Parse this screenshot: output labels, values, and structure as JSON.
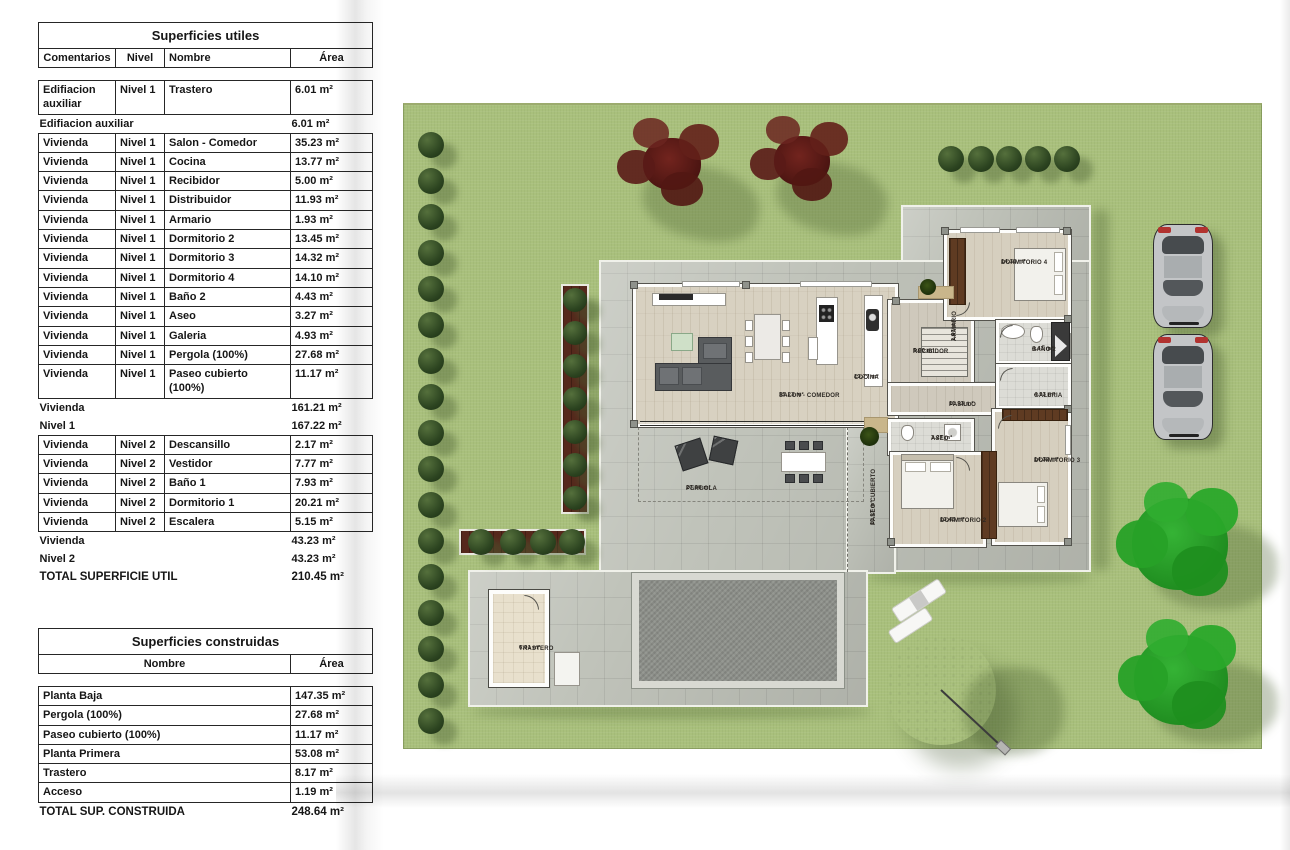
{
  "colors": {
    "lawn": "#a9c07c",
    "terrace": "#c0c3ba",
    "pool_water": "#8e918b",
    "wood_floor": "#d8d1c1",
    "wardrobe_wood": "#5f3b22",
    "bush_green": "#2c4420",
    "tree_red": "#5d1d1a",
    "tree_green": "#2aa02a",
    "table_text": "#161616"
  },
  "tables": {
    "utiles": {
      "title": "Superficies utiles",
      "columns": [
        "Comentarios",
        "Nivel",
        "Nombre",
        "Área"
      ],
      "rows": [
        {
          "type": "data",
          "comentarios": "Edifiacion auxiliar",
          "nivel": "Nivel 1",
          "nombre": "Trastero",
          "area": "6.01 m²"
        },
        {
          "type": "summary",
          "label": "Edifiacion auxiliar",
          "area": "6.01 m²"
        },
        {
          "type": "data",
          "comentarios": "Vivienda",
          "nivel": "Nivel 1",
          "nombre": "Salon - Comedor",
          "area": "35.23 m²"
        },
        {
          "type": "data",
          "comentarios": "Vivienda",
          "nivel": "Nivel 1",
          "nombre": "Cocina",
          "area": "13.77 m²"
        },
        {
          "type": "data",
          "comentarios": "Vivienda",
          "nivel": "Nivel 1",
          "nombre": "Recibidor",
          "area": "5.00 m²"
        },
        {
          "type": "data",
          "comentarios": "Vivienda",
          "nivel": "Nivel 1",
          "nombre": "Distribuidor",
          "area": "11.93 m²"
        },
        {
          "type": "data",
          "comentarios": "Vivienda",
          "nivel": "Nivel 1",
          "nombre": "Armario",
          "area": "1.93 m²"
        },
        {
          "type": "data",
          "comentarios": "Vivienda",
          "nivel": "Nivel 1",
          "nombre": "Dormitorio 2",
          "area": "13.45 m²"
        },
        {
          "type": "data",
          "comentarios": "Vivienda",
          "nivel": "Nivel 1",
          "nombre": "Dormitorio 3",
          "area": "14.32 m²"
        },
        {
          "type": "data",
          "comentarios": "Vivienda",
          "nivel": "Nivel 1",
          "nombre": "Dormitorio 4",
          "area": "14.10 m²"
        },
        {
          "type": "data",
          "comentarios": "Vivienda",
          "nivel": "Nivel 1",
          "nombre": "Baño 2",
          "area": "4.43 m²"
        },
        {
          "type": "data",
          "comentarios": "Vivienda",
          "nivel": "Nivel 1",
          "nombre": "Aseo",
          "area": "3.27 m²"
        },
        {
          "type": "data",
          "comentarios": "Vivienda",
          "nivel": "Nivel 1",
          "nombre": "Galeria",
          "area": "4.93 m²"
        },
        {
          "type": "data",
          "comentarios": "Vivienda",
          "nivel": "Nivel 1",
          "nombre": "Pergola (100%)",
          "area": "27.68 m²"
        },
        {
          "type": "data",
          "comentarios": "Vivienda",
          "nivel": "Nivel 1",
          "nombre": "Paseo cubierto (100%)",
          "area": "11.17 m²"
        },
        {
          "type": "summary",
          "label": "Vivienda",
          "area": "161.21 m²"
        },
        {
          "type": "summary",
          "label": "Nivel 1",
          "area": "167.22 m²"
        },
        {
          "type": "data",
          "comentarios": "Vivienda",
          "nivel": "Nivel 2",
          "nombre": "Descansillo",
          "area": "2.17 m²"
        },
        {
          "type": "data",
          "comentarios": "Vivienda",
          "nivel": "Nivel 2",
          "nombre": "Vestidor",
          "area": "7.77 m²"
        },
        {
          "type": "data",
          "comentarios": "Vivienda",
          "nivel": "Nivel 2",
          "nombre": "Baño 1",
          "area": "7.93 m²"
        },
        {
          "type": "data",
          "comentarios": "Vivienda",
          "nivel": "Nivel 2",
          "nombre": "Dormitorio 1",
          "area": "20.21 m²"
        },
        {
          "type": "data",
          "comentarios": "Vivienda",
          "nivel": "Nivel 2",
          "nombre": "Escalera",
          "area": "5.15 m²"
        },
        {
          "type": "summary",
          "label": "Vivienda",
          "area": "43.23 m²"
        },
        {
          "type": "summary",
          "label": "Nivel 2",
          "area": "43.23 m²"
        },
        {
          "type": "total",
          "label": "TOTAL SUPERFICIE UTIL",
          "area": "210.45 m²"
        }
      ]
    },
    "construidas": {
      "title": "Superficies construidas",
      "columns": [
        "Nombre",
        "Área"
      ],
      "rows": [
        {
          "type": "data",
          "nombre": "Planta Baja",
          "area": "147.35 m²"
        },
        {
          "type": "data",
          "nombre": "Pergola (100%)",
          "area": "27.68 m²"
        },
        {
          "type": "data",
          "nombre": "Paseo cubierto (100%)",
          "area": "11.17 m²"
        },
        {
          "type": "data",
          "nombre": "Planta Primera",
          "area": "53.08 m²"
        },
        {
          "type": "data",
          "nombre": "Trastero",
          "area": "8.17 m²"
        },
        {
          "type": "data",
          "nombre": "Acceso",
          "area": "1.19 m²"
        },
        {
          "type": "total",
          "label": "TOTAL SUP. CONSTRUIDA",
          "area": "248.64 m²"
        }
      ]
    }
  },
  "plan": {
    "rooms": [
      {
        "key": "salon",
        "name": "SALON - COMEDOR",
        "area": "35.23 m²"
      },
      {
        "key": "cocina",
        "name": "COCINA",
        "area": "13.77 m²"
      },
      {
        "key": "recibidor",
        "name": "RECIBIDOR",
        "area": "5.00 m²"
      },
      {
        "key": "armario",
        "name": "ARMARIO",
        "area": "1.93 m²"
      },
      {
        "key": "pasillo",
        "name": "PASILLO",
        "area": "11.93 m²"
      },
      {
        "key": "dormitorio4",
        "name": "DORMITORIO 4",
        "area": "14.10 m²"
      },
      {
        "key": "bano2",
        "name": "BAÑO 2",
        "area": "4.43 m²"
      },
      {
        "key": "galeria",
        "name": "GALERIA",
        "area": "4.93 m²"
      },
      {
        "key": "dormitorio3",
        "name": "DORMITORIO 3",
        "area": "14.32 m²"
      },
      {
        "key": "aseo",
        "name": "ASEO",
        "area": "3.27 m²"
      },
      {
        "key": "dormitorio2",
        "name": "DORMITORIO 2",
        "area": "13.45 m²"
      },
      {
        "key": "pergola",
        "name": "PERGOLA",
        "area": "27.68 m²"
      },
      {
        "key": "paseo",
        "name": "PASEO CUBIERTO",
        "area": "11.17 m²"
      },
      {
        "key": "trastero",
        "name": "TRASTERO",
        "area": "6.01 m²"
      }
    ]
  }
}
